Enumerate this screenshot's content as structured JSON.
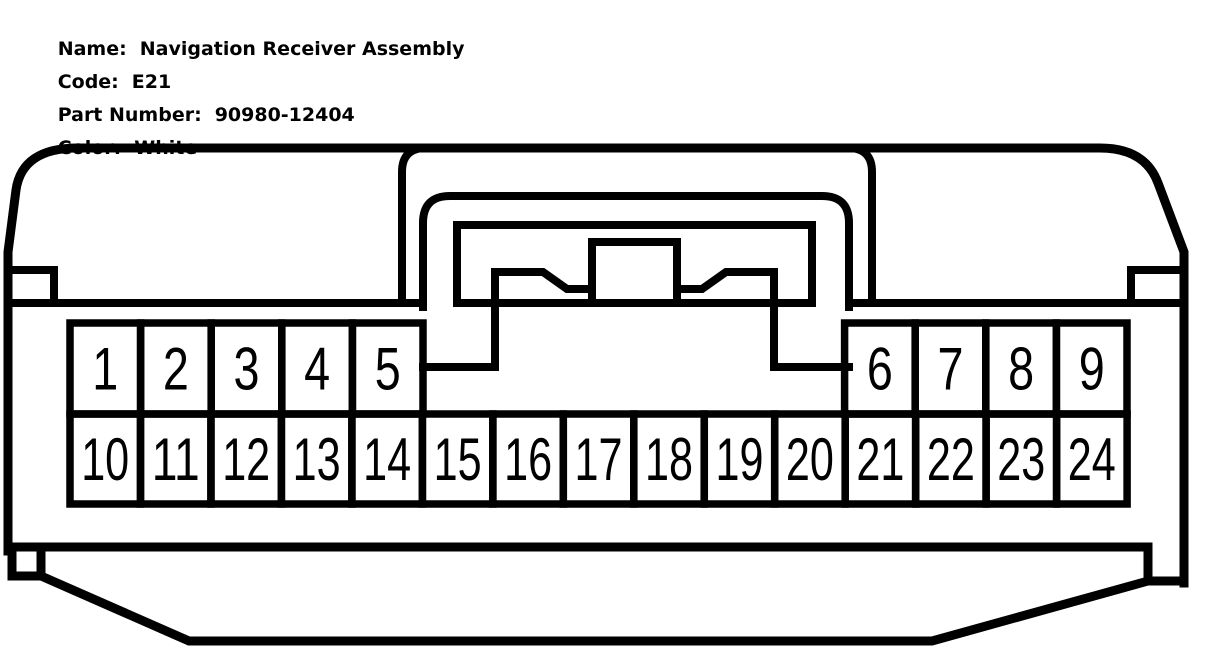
{
  "header": {
    "fields": [
      {
        "label": "Name:",
        "value": "Navigation Receiver Assembly"
      },
      {
        "label": "Code:",
        "value": "E21"
      },
      {
        "label": "Part Number:",
        "value": "90980-12404"
      },
      {
        "label": "Color:",
        "value": "White"
      }
    ]
  },
  "connector": {
    "line_color": "#000000",
    "background_color": "#ffffff",
    "pin_rows": {
      "top_left": [
        "1",
        "2",
        "3",
        "4",
        "5"
      ],
      "top_right": [
        "6",
        "7",
        "8",
        "9"
      ],
      "bottom": [
        "10",
        "11",
        "12",
        "13",
        "14",
        "15",
        "16",
        "17",
        "18",
        "19",
        "20",
        "21",
        "22",
        "23",
        "24"
      ]
    }
  }
}
